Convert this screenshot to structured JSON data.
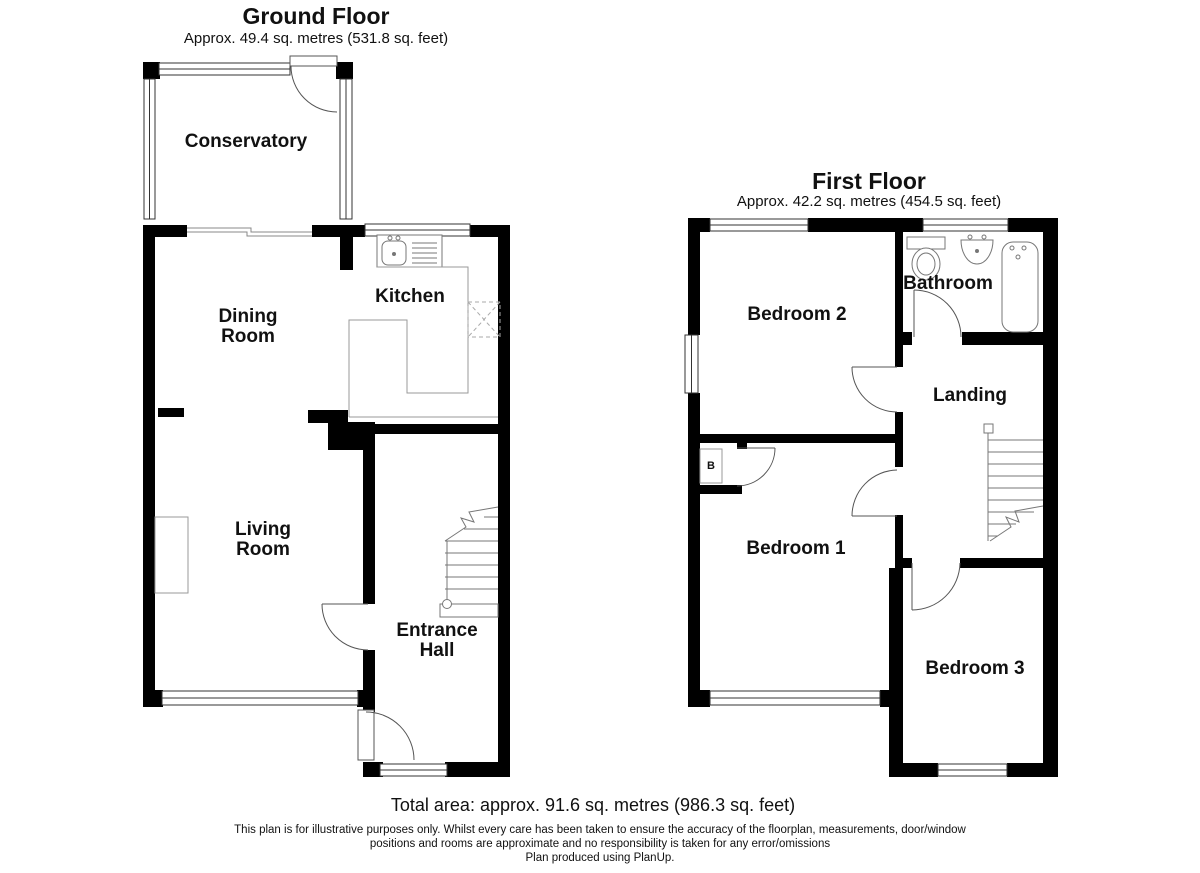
{
  "ground_floor": {
    "title": "Ground Floor",
    "subtitle": "Approx. 49.4 sq. metres (531.8 sq. feet)",
    "rooms": [
      {
        "label": "Conservatory"
      },
      {
        "label": "Dining Room"
      },
      {
        "label": "Kitchen"
      },
      {
        "label": "Living Room"
      },
      {
        "label": "Entrance Hall"
      }
    ]
  },
  "first_floor": {
    "title": "First Floor",
    "subtitle": "Approx. 42.2 sq. metres (454.5 sq. feet)",
    "rooms": [
      {
        "label": "Bedroom 2"
      },
      {
        "label": "Bathroom"
      },
      {
        "label": "Landing"
      },
      {
        "label": "Bedroom 1"
      },
      {
        "label": "Bedroom 3"
      }
    ],
    "boiler_cupboard_label": "B"
  },
  "footer": {
    "total_area": "Total area: approx. 91.6 sq. metres (986.3 sq. feet)",
    "disclaimer_line1": "This plan is for illustrative purposes only. Whilst every care has been taken to ensure the accuracy of the floorplan, measurements, door/window",
    "disclaimer_line2": "positions and rooms are approximate and no responsibility is taken for any error/omissions",
    "disclaimer_line3": "Plan produced using PlanUp."
  },
  "colors": {
    "wall": "#000000",
    "fixture_line": "#777777",
    "counter_line": "#999999",
    "door_line": "#555555",
    "window_line": "#333333"
  }
}
